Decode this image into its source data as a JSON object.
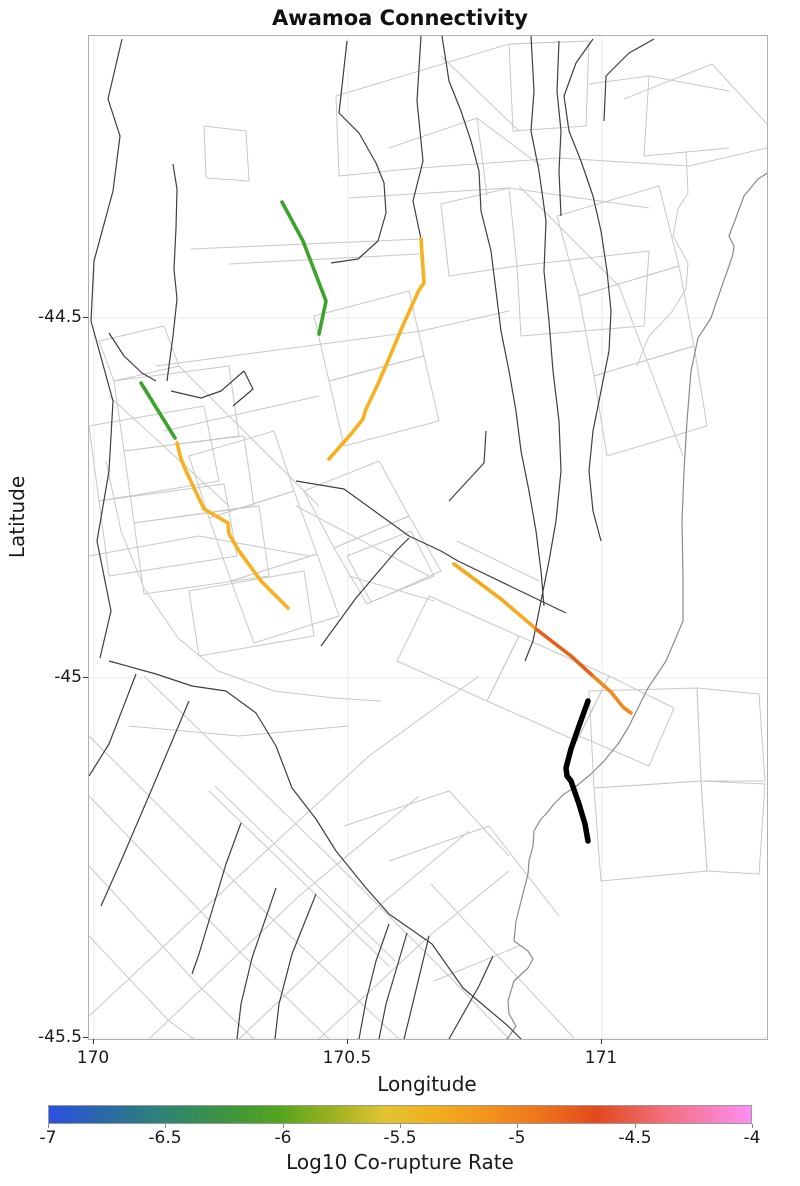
{
  "title": "Awamoa Connectivity",
  "axes": {
    "x": {
      "label": "Longitude",
      "ticks": [
        {
          "label": "170",
          "x": 93
        },
        {
          "label": "170.5",
          "x": 347
        },
        {
          "label": "171",
          "x": 601
        }
      ]
    },
    "y": {
      "label": "Latitude",
      "ticks": [
        {
          "label": "-44.5",
          "y": 317
        },
        {
          "label": "-45",
          "y": 677
        },
        {
          "label": "-45.5",
          "y": 1037
        }
      ]
    }
  },
  "colorbar": {
    "label": "Log10 Co-rupture Rate",
    "min": -7,
    "max": -4,
    "ticks": [
      {
        "label": "-7",
        "x": 48
      },
      {
        "label": "-6.5",
        "x": 165
      },
      {
        "label": "-6",
        "x": 283
      },
      {
        "label": "-5.5",
        "x": 400
      },
      {
        "label": "-5",
        "x": 517
      },
      {
        "label": "-4.5",
        "x": 635
      },
      {
        "label": "-4",
        "x": 752
      }
    ],
    "stops": [
      {
        "pos": 0,
        "color": "#2b50e0"
      },
      {
        "pos": 8,
        "color": "#2a6aa8"
      },
      {
        "pos": 16,
        "color": "#2e8376"
      },
      {
        "pos": 25,
        "color": "#3d9440"
      },
      {
        "pos": 33,
        "color": "#55a41e"
      },
      {
        "pos": 41,
        "color": "#a3b322"
      },
      {
        "pos": 48,
        "color": "#e2c430"
      },
      {
        "pos": 55,
        "color": "#f0ae1f"
      },
      {
        "pos": 62,
        "color": "#f2951d"
      },
      {
        "pos": 70,
        "color": "#ee751b"
      },
      {
        "pos": 78,
        "color": "#e2491c"
      },
      {
        "pos": 88,
        "color": "#f3707f"
      },
      {
        "pos": 100,
        "color": "#fb8ef2"
      }
    ]
  },
  "chart_data": {
    "type": "map",
    "title": "Awamoa Connectivity",
    "xlabel": "Longitude",
    "ylabel": "Latitude",
    "xlim": [
      169.99,
      171.33
    ],
    "ylim": [
      -45.5,
      -44.11
    ],
    "grid": true,
    "gridlines": {
      "x": [
        170,
        170.5,
        171
      ],
      "y": [
        -44.5,
        -45,
        -45.5
      ]
    },
    "colorbar": {
      "label": "Log10 Co-rupture Rate",
      "range": [
        -7,
        -4
      ]
    },
    "description": "Fault network base map (light gray fault sections, dark gray fault traces, gray coastline) with highlighted co-rupture segments colored by log10 co-rupture rate and one thick black segment (the Awamoa source fault).",
    "highlighted_segments": [
      {
        "name": "green-segment-north",
        "approx_rate": -6.0,
        "color": "#3CA42B",
        "width": 3.6,
        "lonlat": [
          [
            170.37,
            -44.34
          ],
          [
            170.44,
            -44.52
          ]
        ],
        "points": [
          [
            193,
            166
          ],
          [
            214,
            205
          ],
          [
            237,
            265
          ],
          [
            230,
            298
          ]
        ]
      },
      {
        "name": "green-segment-west",
        "approx_rate": -6.0,
        "color": "#3CA42B",
        "width": 3.6,
        "lonlat": [
          [
            170.09,
            -44.59
          ],
          [
            170.16,
            -44.67
          ]
        ],
        "points": [
          [
            52,
            347
          ],
          [
            86,
            402
          ]
        ]
      },
      {
        "name": "amber-segment-west",
        "approx_rate": -5.4,
        "color": "#F7B01E",
        "width": 3.6,
        "lonlat": [
          [
            170.16,
            -44.67
          ],
          [
            170.38,
            -44.9
          ]
        ],
        "points": [
          [
            88,
            407
          ],
          [
            92,
            423
          ],
          [
            97,
            435
          ],
          [
            115,
            473
          ],
          [
            139,
            487
          ],
          [
            140,
            498
          ],
          [
            150,
            515
          ],
          [
            172,
            545
          ],
          [
            199,
            572
          ]
        ]
      },
      {
        "name": "amber-segment-central",
        "approx_rate": -5.5,
        "color": "#F7B01E",
        "width": 3.6,
        "lonlat": [
          [
            170.64,
            -44.39
          ],
          [
            170.46,
            -44.7
          ]
        ],
        "points": [
          [
            332,
            203
          ],
          [
            335,
            247
          ],
          [
            330,
            254
          ],
          [
            325,
            265
          ],
          [
            315,
            287
          ],
          [
            298,
            327
          ],
          [
            289,
            348
          ],
          [
            277,
            373
          ],
          [
            274,
            383
          ],
          [
            262,
            398
          ],
          [
            240,
            423
          ]
        ]
      },
      {
        "name": "southeast-segment-amber-part",
        "approx_rate": -5.3,
        "color": "#F6A91E",
        "width": 3.6,
        "lonlat": [
          [
            170.71,
            -44.84
          ],
          [
            170.87,
            -44.95
          ]
        ],
        "points": [
          [
            365,
            528
          ],
          [
            412,
            563
          ],
          [
            447,
            593
          ]
        ]
      },
      {
        "name": "southeast-segment-red-orange-part",
        "approx_rate": -4.7,
        "color": "#E8611A",
        "width": 3.6,
        "lonlat": [
          [
            170.87,
            -44.95
          ],
          [
            170.99,
            -45.0
          ]
        ],
        "points": [
          [
            447,
            593
          ],
          [
            482,
            620
          ],
          [
            505,
            641
          ]
        ]
      },
      {
        "name": "southeast-segment-orange-part",
        "approx_rate": -5.0,
        "color": "#F08A1E",
        "width": 3.6,
        "lonlat": [
          [
            170.99,
            -45.0
          ],
          [
            171.06,
            -45.05
          ]
        ],
        "points": [
          [
            505,
            641
          ],
          [
            522,
            656
          ],
          [
            534,
            671
          ],
          [
            542,
            677
          ]
        ]
      },
      {
        "name": "black-source-segment",
        "approx_rate": null,
        "color": "#000000",
        "width": 5.5,
        "lonlat": [
          [
            170.97,
            -45.03
          ],
          [
            170.97,
            -45.23
          ]
        ],
        "points": [
          [
            499,
            665
          ],
          [
            490,
            690
          ],
          [
            482,
            713
          ],
          [
            477,
            732
          ],
          [
            478,
            740
          ],
          [
            482,
            745
          ],
          [
            490,
            768
          ],
          [
            496,
            788
          ],
          [
            499,
            805
          ]
        ]
      }
    ]
  }
}
